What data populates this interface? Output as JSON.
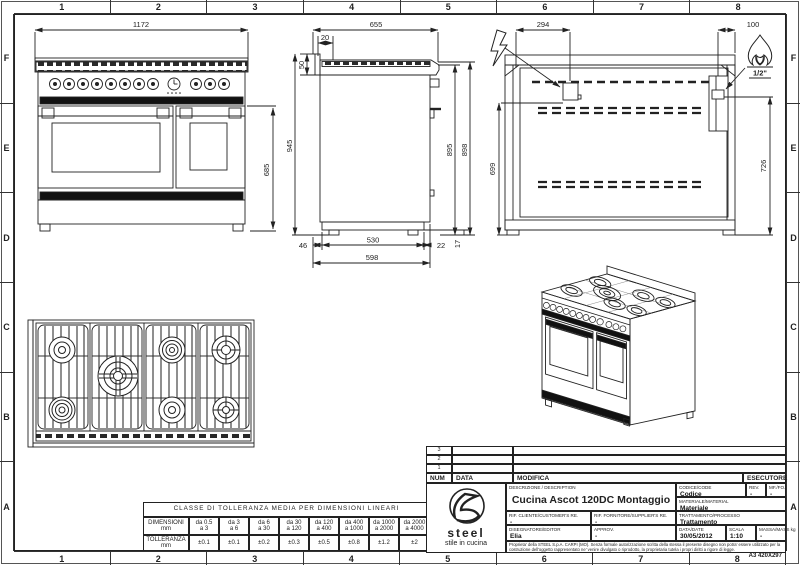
{
  "colors": {
    "line": "#222222",
    "dark_fill": "#111111",
    "paper": "#ffffff"
  },
  "sheet": {
    "zone_columns": [
      "1",
      "2",
      "3",
      "4",
      "5",
      "6",
      "7",
      "8"
    ],
    "zone_rows": [
      "F",
      "E",
      "D",
      "C",
      "B",
      "A"
    ],
    "format_label": "A3 420X297"
  },
  "front_view": {
    "width": "1172",
    "door_height": "685"
  },
  "side_view": {
    "depth": "655",
    "top_offset": "20",
    "splash_height": "50",
    "total_height": "945",
    "body_height": "895",
    "back_height": "898",
    "front_gap": "46",
    "feet_span": "530",
    "back_gap": "22",
    "base_depth": "598",
    "foot_height": "17"
  },
  "back_view": {
    "electric_offset_x": "294",
    "gas_offset_x": "100",
    "electric_height": "699",
    "gas_height": "726",
    "gas_connection": "1/2\""
  },
  "tolerance_table": {
    "title": "CLASSE DI TOLLERANZA MEDIA PER DIMENSIONI LINEARI",
    "dim_label": "DIMENSIONI",
    "dim_unit": "mm",
    "tol_label": "TOLLERANZA",
    "tol_unit": "mm",
    "ranges": [
      [
        "da 0.5",
        "a 3"
      ],
      [
        "da 3",
        "a 6"
      ],
      [
        "da 6",
        "a 30"
      ],
      [
        "da 30",
        "a 120"
      ],
      [
        "da 120",
        "a 400"
      ],
      [
        "da 400",
        "a 1000"
      ],
      [
        "da 1000",
        "a 2000"
      ],
      [
        "da 2000",
        "a 4000"
      ]
    ],
    "tolerances": [
      "±0.1",
      "±0.1",
      "±0.2",
      "±0.3",
      "±0.5",
      "±0.8",
      "±1.2",
      "±2"
    ]
  },
  "title_block": {
    "revision_rows": [
      "3",
      "2",
      "1"
    ],
    "num_label": "NUM",
    "data_col_label": "DATA",
    "modifica_label": "MODIFICA",
    "esecutore_label": "ESECUTORE",
    "logo_text": "steel",
    "logo_tagline": "stile in cucina",
    "description_label": "DESCRIZIONE / DESCRIPTION",
    "description": "Cucina Ascot 120DC Montaggio",
    "codice_label": "CODICE/CODE",
    "codice": "Codice",
    "rev_label": "REV.",
    "rev": "-",
    "mf_label": "MF./FO.",
    "mf": "-",
    "materiale_label": "MATERIALE/MATERIAL",
    "materiale": "Materiale",
    "trattamento_label": "TRATTAMENTO/PROCESSO",
    "trattamento": "Trattamento",
    "rif_cliente_label": "RIF. CLIENTE/CUSTOMER'S RE.",
    "rif_cliente": "-",
    "rif_fornitore_label": "RIF. FORNITORE/SUPPLIER'S RE.",
    "rif_fornitore": "-",
    "disegnatore_label": "DISEGNATORE/EDITOR",
    "disegnatore": "Elia",
    "approv_label": "APPROV.",
    "approv": "-",
    "date_label": "DATA/DATE",
    "date": "30/05/2012",
    "scala_label": "SCALA",
    "scala": "1:10",
    "massa_label": "MASSA/MASS kg",
    "massa": "-",
    "legal": "Proprieta' della STEEL S.p.A. CARPI (MO). Senza formale autorizzazione scritta della stessa il presente disegno non potra' essere utilizzato per la costruzione dell'oggetto rappresentato ne' venire divulgato o riprodotto, la proprietaria tutela i propri diritti a rigore di legge."
  }
}
